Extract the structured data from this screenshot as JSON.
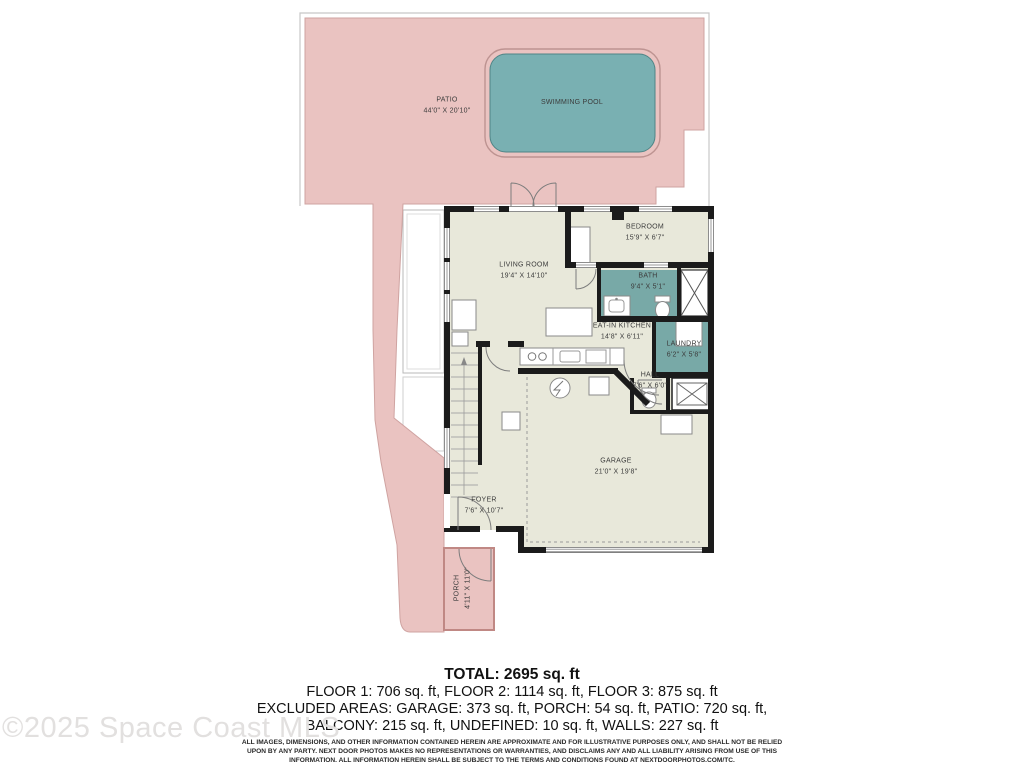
{
  "plan": {
    "rooms": [
      {
        "name": "PATIO",
        "dims": "44'0\" X 20'10\""
      },
      {
        "name": "SWIMMING POOL",
        "dims": ""
      },
      {
        "name": "LIVING ROOM",
        "dims": "19'4\" X 14'10\""
      },
      {
        "name": "BEDROOM",
        "dims": "15'9\" X 6'7\""
      },
      {
        "name": "BATH",
        "dims": "9'4\" X 5'1\""
      },
      {
        "name": "EAT-IN KITCHEN",
        "dims": "14'8\" X 6'11\""
      },
      {
        "name": "LAUNDRY",
        "dims": "6'2\" X 5'8\""
      },
      {
        "name": "HALL",
        "dims": "7'6\" X 6'0\""
      },
      {
        "name": "GARAGE",
        "dims": "21'0\" X 19'8\""
      },
      {
        "name": "FOYER",
        "dims": "7'6\" X 10'7\""
      },
      {
        "name": "PORCH",
        "dims": "4'11\" X 11'0\""
      }
    ],
    "colors": {
      "patio": "#eac3c1",
      "pool": "#79b0b2",
      "wetroom": "#78a9a7",
      "floor": "#e8e8da",
      "wall": "#1b1b1b",
      "porch": "#eac3c1"
    }
  },
  "summary": {
    "total": "TOTAL: 2695 sq. ft",
    "floors": "FLOOR 1: 706 sq. ft, FLOOR 2: 1114 sq. ft, FLOOR 3: 875 sq. ft",
    "excluded1": "EXCLUDED AREAS: GARAGE: 373 sq. ft, PORCH: 54 sq. ft, PATIO: 720 sq. ft,",
    "excluded2": "BALCONY: 215 sq. ft, UNDEFINED: 10 sq. ft, WALLS: 227 sq. ft",
    "disclaimer": "ALL IMAGES, DIMENSIONS, AND OTHER INFORMATION CONTAINED HEREIN ARE APPROXIMATE AND FOR ILLUSTRATIVE PURPOSES ONLY, AND SHALL NOT BE RELIED UPON BY ANY PARTY. NEXT DOOR PHOTOS MAKES NO REPRESENTATIONS OR WARRANTIES, AND DISCLAIMS ANY AND ALL LIABILITY ARISING FROM USE OF THIS INFORMATION. ALL INFORMATION HEREIN SHALL BE SUBJECT TO THE TERMS AND CONDITIONS FOUND AT NEXTDOORPHOTOS.COM/TC."
  },
  "watermark": "©2025 Space Coast MLS"
}
